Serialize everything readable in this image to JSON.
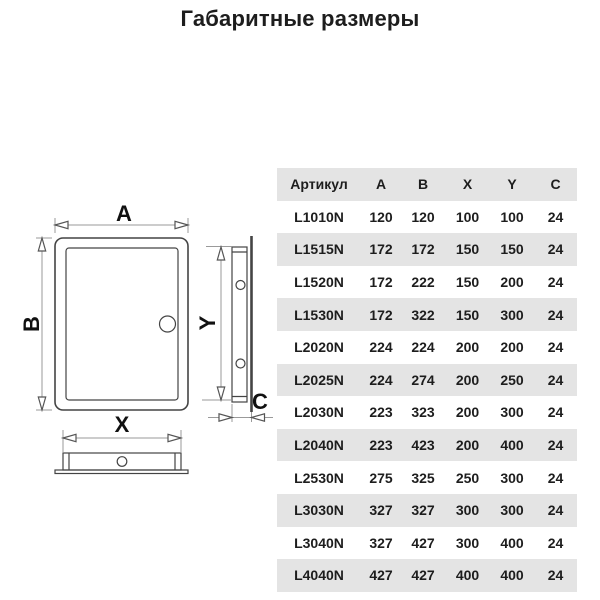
{
  "title": "Габаритные размеры",
  "drawing": {
    "front_view": {
      "label_width": "A",
      "label_height": "B"
    },
    "side_view": {
      "label_height": "Y",
      "label_depth": "C"
    },
    "bottom_view": {
      "label_width": "X"
    }
  },
  "table": {
    "columns": [
      "Артикул",
      "A",
      "B",
      "X",
      "Y",
      "C"
    ],
    "column_keys": [
      "article",
      "a",
      "b",
      "x",
      "y",
      "c"
    ],
    "rows": [
      [
        "L1010N",
        "120",
        "120",
        "100",
        "100",
        "24"
      ],
      [
        "L1515N",
        "172",
        "172",
        "150",
        "150",
        "24"
      ],
      [
        "L1520N",
        "172",
        "222",
        "150",
        "200",
        "24"
      ],
      [
        "L1530N",
        "172",
        "322",
        "150",
        "300",
        "24"
      ],
      [
        "L2020N",
        "224",
        "224",
        "200",
        "200",
        "24"
      ],
      [
        "L2025N",
        "224",
        "274",
        "200",
        "250",
        "24"
      ],
      [
        "L2030N",
        "223",
        "323",
        "200",
        "300",
        "24"
      ],
      [
        "L2040N",
        "223",
        "423",
        "200",
        "400",
        "24"
      ],
      [
        "L2530N",
        "275",
        "325",
        "250",
        "300",
        "24"
      ],
      [
        "L3030N",
        "327",
        "327",
        "300",
        "300",
        "24"
      ],
      [
        "L3040N",
        "327",
        "427",
        "300",
        "400",
        "24"
      ],
      [
        "L4040N",
        "427",
        "427",
        "400",
        "400",
        "24"
      ]
    ]
  },
  "colors": {
    "stripe": "#e4e4e4",
    "text": "#1d1d1d",
    "shape_line": "#444444",
    "dim_line": "#9a9a9a"
  }
}
